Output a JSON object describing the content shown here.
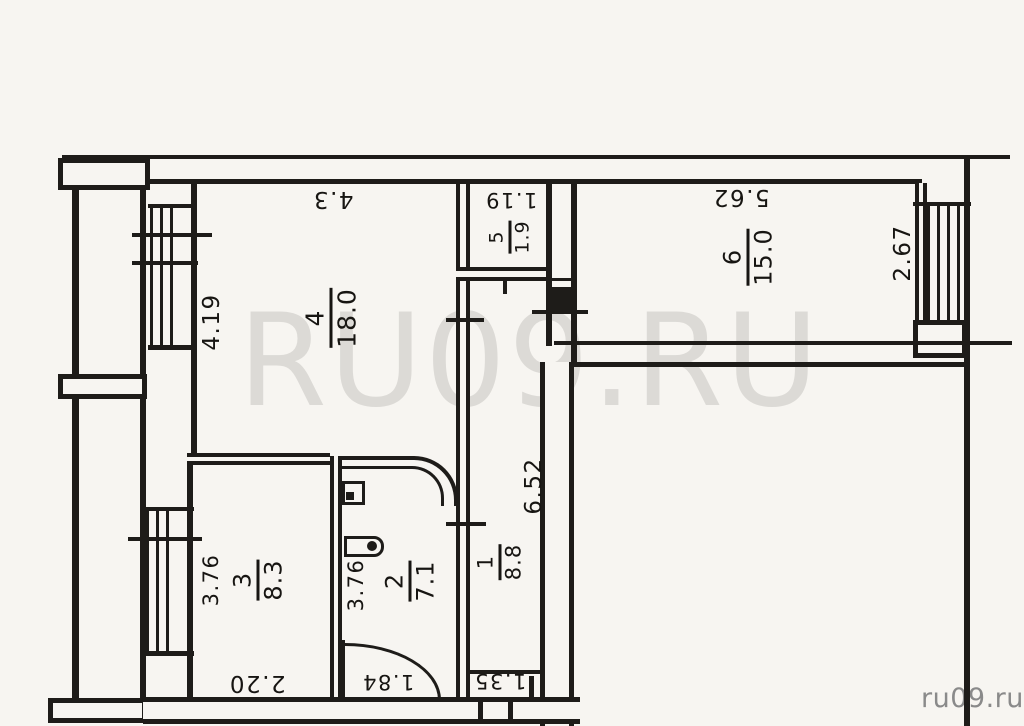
{
  "watermark": "RU09.RU",
  "credit": "ru09.ru",
  "rooms": {
    "r1": {
      "number": "1",
      "area": "8.8"
    },
    "r2": {
      "number": "2",
      "area": "7.1"
    },
    "r3": {
      "number": "3",
      "area": "8.3"
    },
    "r4": {
      "number": "4",
      "area": "18.0"
    },
    "r5": {
      "number": "5",
      "area": "1.9"
    },
    "r6": {
      "number": "6",
      "area": "15.0"
    }
  },
  "dimensions": {
    "room4_width": "4.3",
    "room4_depth": "4.19",
    "room5_width": "1.19",
    "room6_width": "5.62",
    "room6_depth": "2.67",
    "hall_length": "6.52",
    "room3_depth": "3.76",
    "room2_depth": "3.76",
    "room3_width": "2.20",
    "room2_width": "1.84",
    "hall_width": "1.35"
  }
}
